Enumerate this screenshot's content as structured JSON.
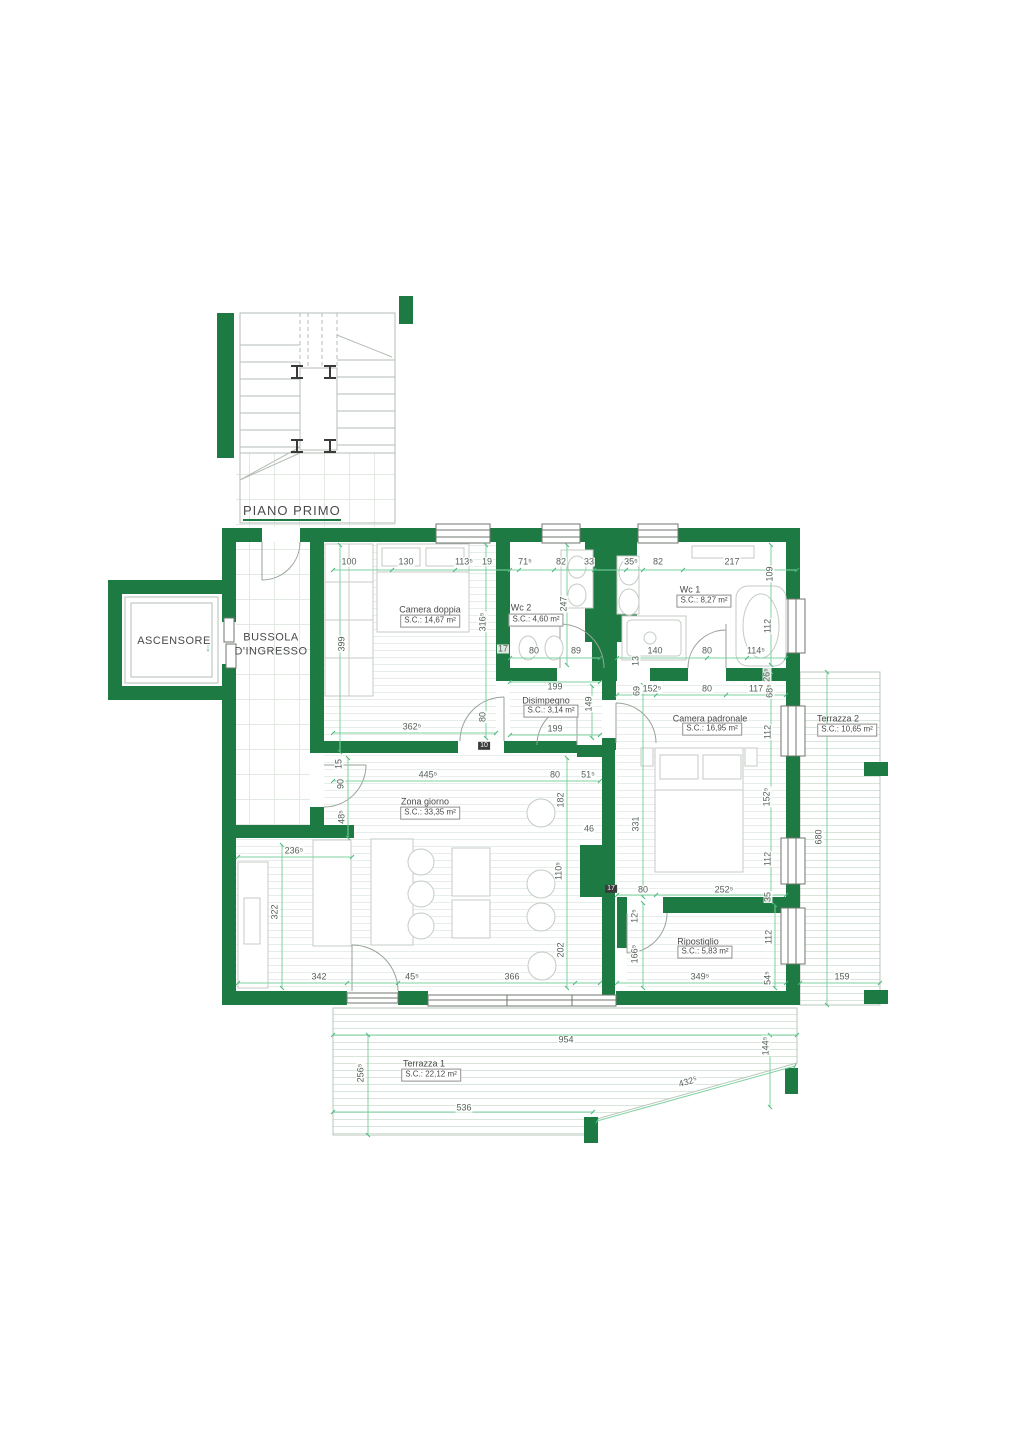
{
  "colors": {
    "wall_green": "#1e7a43",
    "dimension_green": "#7dd2a2",
    "tick_green": "#49b87a",
    "text_gray": "#4a4a4a"
  },
  "floor_label": "PIANO PRIMO",
  "elevator": {
    "label": "ASCENSORE",
    "arrow": "↓"
  },
  "entrance": {
    "line1": "BUSSOLA",
    "line2": "D'INGRESSO"
  },
  "rooms": [
    {
      "id": "camera-doppia",
      "name": "Camera doppia",
      "area": "S.C.: 14,67 m²",
      "nx": 430,
      "ny": 610,
      "bx": 430,
      "by": 621
    },
    {
      "id": "wc2",
      "name": "Wc 2",
      "area": "S.C.: 4,60 m²",
      "nx": 521,
      "ny": 608,
      "bx": 536,
      "by": 620
    },
    {
      "id": "wc1",
      "name": "Wc 1",
      "area": "S.C.: 8,27 m²",
      "nx": 690,
      "ny": 590,
      "bx": 704,
      "by": 601
    },
    {
      "id": "disimpegno",
      "name": "Disimpegno",
      "area": "S.C.: 3,14 m²",
      "nx": 546,
      "ny": 701,
      "bx": 551,
      "by": 711
    },
    {
      "id": "camera-padronale",
      "name": "Camera padronale",
      "area": "S.C.: 16,95 m²",
      "nx": 710,
      "ny": 719,
      "bx": 712,
      "by": 729
    },
    {
      "id": "zona-giorno",
      "name": "Zona giorno",
      "area": "S.C.: 33,35 m²",
      "nx": 425,
      "ny": 802,
      "bx": 430,
      "by": 813
    },
    {
      "id": "ripostiglio",
      "name": "Ripostiglio",
      "area": "S.C.: 5,83 m²",
      "nx": 698,
      "ny": 942,
      "bx": 705,
      "by": 952
    },
    {
      "id": "terrazza1",
      "name": "Terrazza 1",
      "area": "S.C.: 22,12 m²",
      "nx": 424,
      "ny": 1064,
      "bx": 431,
      "by": 1075
    },
    {
      "id": "terrazza2",
      "name": "Terrazza 2",
      "area": "S.C.: 10,65 m²",
      "nx": 838,
      "ny": 719,
      "bx": 847,
      "by": 730
    }
  ],
  "markers": [
    {
      "t": "10",
      "x": 484,
      "y": 746
    },
    {
      "t": "17",
      "x": 611,
      "y": 889
    }
  ],
  "dimensions": [
    {
      "t": "100",
      "x": 349,
      "y": 562
    },
    {
      "t": "130",
      "x": 406,
      "y": 562
    },
    {
      "t": "113⁵",
      "x": 464,
      "y": 562
    },
    {
      "t": "19",
      "x": 487,
      "y": 562
    },
    {
      "t": "71⁵",
      "x": 525,
      "y": 562
    },
    {
      "t": "82",
      "x": 561,
      "y": 562
    },
    {
      "t": "33",
      "x": 589,
      "y": 562
    },
    {
      "t": "35⁵",
      "x": 631,
      "y": 562
    },
    {
      "t": "82",
      "x": 658,
      "y": 562
    },
    {
      "t": "217",
      "x": 732,
      "y": 562
    },
    {
      "t": "109",
      "x": 770,
      "y": 574,
      "r": "v"
    },
    {
      "t": "399",
      "x": 342,
      "y": 644,
      "r": "v"
    },
    {
      "t": "316⁵",
      "x": 483,
      "y": 622,
      "r": "v"
    },
    {
      "t": "247",
      "x": 564,
      "y": 604,
      "r": "v"
    },
    {
      "t": "17",
      "x": 503,
      "y": 649
    },
    {
      "t": "80",
      "x": 534,
      "y": 651
    },
    {
      "t": "89",
      "x": 576,
      "y": 651
    },
    {
      "t": "13",
      "x": 636,
      "y": 661,
      "r": "v"
    },
    {
      "t": "140",
      "x": 655,
      "y": 651
    },
    {
      "t": "80",
      "x": 707,
      "y": 651
    },
    {
      "t": "114⁵",
      "x": 756,
      "y": 651
    },
    {
      "t": "112",
      "x": 768,
      "y": 626,
      "r": "v"
    },
    {
      "t": "199",
      "x": 555,
      "y": 687
    },
    {
      "t": "149",
      "x": 589,
      "y": 704,
      "r": "v"
    },
    {
      "t": "199",
      "x": 555,
      "y": 729
    },
    {
      "t": "69",
      "x": 637,
      "y": 691,
      "r": "v"
    },
    {
      "t": "152⁵",
      "x": 652,
      "y": 689
    },
    {
      "t": "80",
      "x": 707,
      "y": 689
    },
    {
      "t": "117",
      "x": 756,
      "y": 689
    },
    {
      "t": "26⁵",
      "x": 767,
      "y": 675,
      "r": "v"
    },
    {
      "t": "68⁵",
      "x": 770,
      "y": 691,
      "r": "v"
    },
    {
      "t": "112",
      "x": 768,
      "y": 732,
      "r": "v"
    },
    {
      "t": "152⁵",
      "x": 767,
      "y": 797,
      "r": "v"
    },
    {
      "t": "112",
      "x": 768,
      "y": 859,
      "r": "v"
    },
    {
      "t": "331",
      "x": 636,
      "y": 824,
      "r": "v"
    },
    {
      "t": "680",
      "x": 819,
      "y": 837,
      "r": "v"
    },
    {
      "t": "80",
      "x": 643,
      "y": 890
    },
    {
      "t": "252⁵",
      "x": 724,
      "y": 890
    },
    {
      "t": "35",
      "x": 768,
      "y": 897,
      "r": "v"
    },
    {
      "t": "362⁵",
      "x": 412,
      "y": 727
    },
    {
      "t": "80",
      "x": 483,
      "y": 717,
      "r": "v"
    },
    {
      "t": "445⁵",
      "x": 428,
      "y": 775
    },
    {
      "t": "80",
      "x": 555,
      "y": 775
    },
    {
      "t": "51⁵",
      "x": 588,
      "y": 775
    },
    {
      "t": "15",
      "x": 339,
      "y": 764,
      "r": "v"
    },
    {
      "t": "90",
      "x": 341,
      "y": 784,
      "r": "v"
    },
    {
      "t": "48⁵",
      "x": 342,
      "y": 817,
      "r": "v"
    },
    {
      "t": "182",
      "x": 561,
      "y": 800,
      "r": "v"
    },
    {
      "t": "46",
      "x": 589,
      "y": 829
    },
    {
      "t": "110⁵",
      "x": 559,
      "y": 871,
      "r": "v"
    },
    {
      "t": "236⁵",
      "x": 294,
      "y": 851
    },
    {
      "t": "322",
      "x": 275,
      "y": 912,
      "r": "v"
    },
    {
      "t": "342",
      "x": 319,
      "y": 977
    },
    {
      "t": "45⁵",
      "x": 412,
      "y": 977
    },
    {
      "t": "366",
      "x": 512,
      "y": 977
    },
    {
      "t": "202",
      "x": 561,
      "y": 950,
      "r": "v"
    },
    {
      "t": "12⁵",
      "x": 635,
      "y": 916,
      "r": "v"
    },
    {
      "t": "166⁵",
      "x": 635,
      "y": 954,
      "r": "v"
    },
    {
      "t": "112",
      "x": 769,
      "y": 937,
      "r": "v"
    },
    {
      "t": "349⁵",
      "x": 700,
      "y": 977
    },
    {
      "t": "54⁵",
      "x": 768,
      "y": 978,
      "r": "v"
    },
    {
      "t": "954",
      "x": 566,
      "y": 1040
    },
    {
      "t": "144⁵",
      "x": 766,
      "y": 1046,
      "r": "v"
    },
    {
      "t": "256⁵",
      "x": 361,
      "y": 1073,
      "r": "v"
    },
    {
      "t": "536",
      "x": 464,
      "y": 1108
    },
    {
      "t": "432⁵",
      "x": 688,
      "y": 1082,
      "r": "d"
    },
    {
      "t": "159",
      "x": 842,
      "y": 977
    }
  ]
}
